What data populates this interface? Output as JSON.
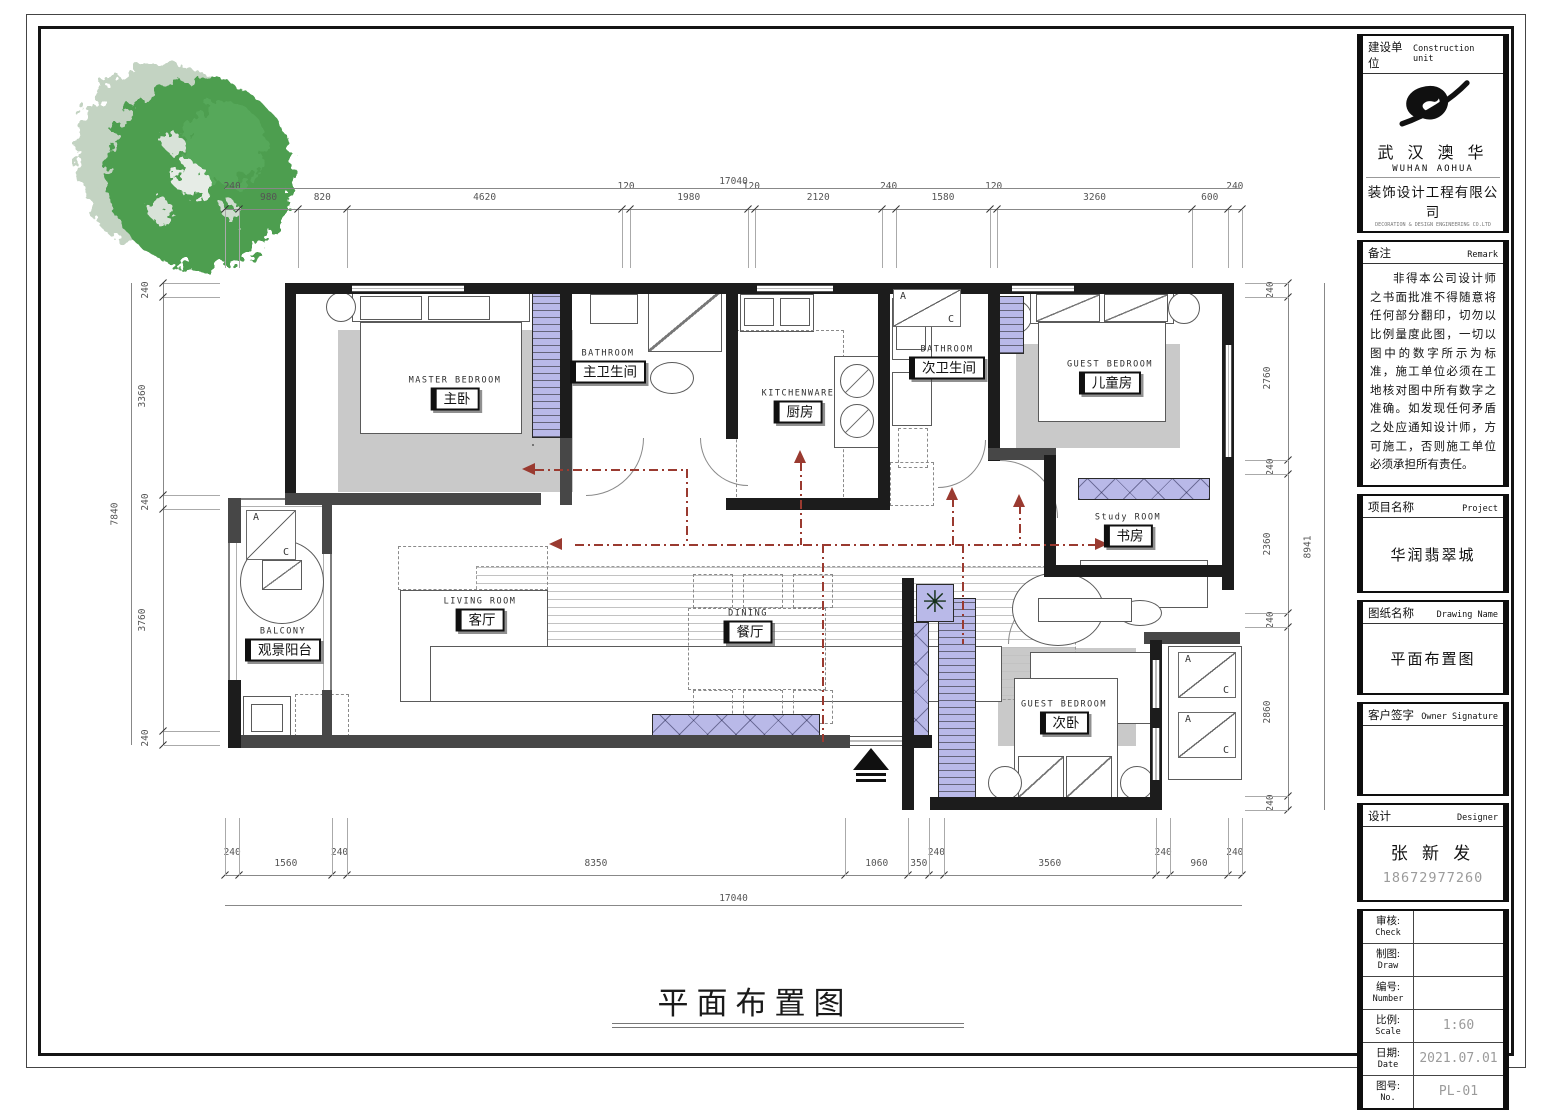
{
  "sheet": {
    "title": "平面布置图"
  },
  "title_block": {
    "construction_unit": {
      "label_cn": "建设单位",
      "label_en": "Construction unit",
      "company_cn": "武 汉 澳 华",
      "company_en": "WUHAN  AOHUA",
      "company_cn_sub": "装饰设计工程有限公司",
      "company_en_sub": "DECORATION & DESIGN ENGINEERING CO.LTD"
    },
    "remark": {
      "label_cn": "备注",
      "label_en": "Remark",
      "text": "非得本公司设计师之书面批准不得随意将任何部分翻印，切勿以比例量度此图，一切以图中的数字所示为标准，施工单位必须在工地核对图中所有数字之准确。如发现任何矛盾之处应通知设计师，方可施工，否则施工单位必须承担所有责任。"
    },
    "project": {
      "label_cn": "项目名称",
      "label_en": "Project",
      "value": "华润翡翠城"
    },
    "drawing_name": {
      "label_cn": "图纸名称",
      "label_en": "Drawing Name",
      "value": "平面布置图"
    },
    "owner_signature": {
      "label_cn": "客户签字",
      "label_en": "Owner Signature",
      "value": ""
    },
    "designer": {
      "label_cn": "设计",
      "label_en": "Designer",
      "name": "张 新 发",
      "phone": "18672977260"
    },
    "table": [
      {
        "label_cn": "审核:",
        "label_en": "Check",
        "value": ""
      },
      {
        "label_cn": "制图:",
        "label_en": "Draw",
        "value": ""
      },
      {
        "label_cn": "编号:",
        "label_en": "Number",
        "value": ""
      },
      {
        "label_cn": "比例:",
        "label_en": "Scale",
        "value": "1:60"
      },
      {
        "label_cn": "日期:",
        "label_en": "Date",
        "value": "2021.07.01"
      },
      {
        "label_cn": "图号:",
        "label_en": "No.",
        "value": "PL-01"
      }
    ]
  },
  "plan": {
    "rooms": {
      "master": {
        "en": "MASTER  BEDROOM",
        "cn": "主卧"
      },
      "master_bath": {
        "en": "BATHROOM",
        "cn": "主卫生间"
      },
      "kitchen": {
        "en": "KITCHENWARE",
        "cn": "厨房"
      },
      "second_bath": {
        "en": "BATHROOM",
        "cn": "次卫生间"
      },
      "children": {
        "en": "GUEST  BEDROOM",
        "cn": "儿童房"
      },
      "study": {
        "en": "Study  ROOM",
        "cn": "书房"
      },
      "balcony": {
        "en": "BALCONY",
        "cn": "观景阳台"
      },
      "living": {
        "en": "LIVING  ROOM",
        "cn": "客厅"
      },
      "dining": {
        "en": "DINING",
        "cn": "餐厅"
      },
      "guest": {
        "en": "GUEST  BEDROOM",
        "cn": "次卧"
      }
    },
    "ac_a": "A",
    "ac_c": "C"
  },
  "dimensions": {
    "top_total": "17040",
    "top_chain": [
      240,
      980,
      820,
      4620,
      120,
      1980,
      120,
      2120,
      240,
      1580,
      120,
      3260,
      600,
      240
    ],
    "bottom_chain": [
      240,
      1560,
      240,
      8350,
      1060,
      350,
      240,
      3560,
      240,
      960,
      240
    ],
    "bottom_total": "17040",
    "left_chain": [
      240,
      3360,
      240,
      3760,
      240
    ],
    "left_total": "7840",
    "right_chain": [
      240,
      2760,
      240,
      2360,
      240,
      2860,
      240
    ],
    "right_total": "8941"
  },
  "colors": {
    "wall": "#1c1c1c",
    "wall_gray": "#474747",
    "closet_fill": "#b9b9e8",
    "rug": "#c9c9c9",
    "circulation": "#9a3a30",
    "tree_green": "#4d9e50",
    "tree_pale": "#c3d3c2"
  }
}
